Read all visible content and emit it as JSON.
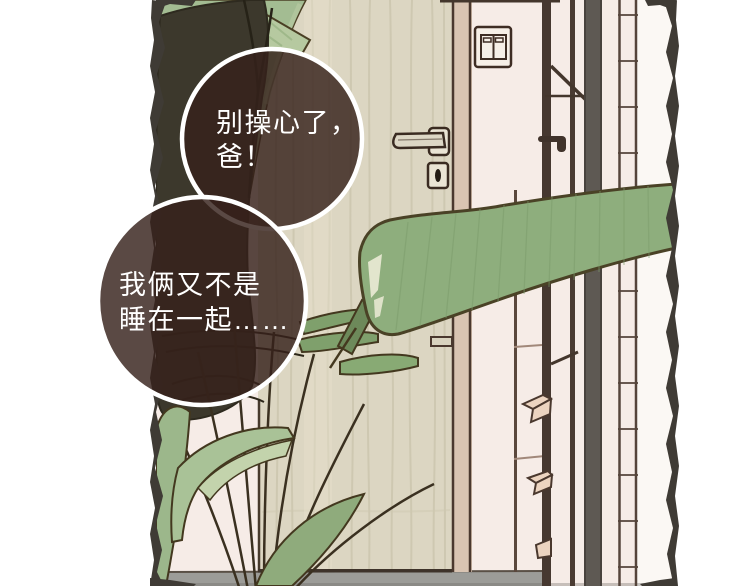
{
  "scene": {
    "bubbles": {
      "bubble1": {
        "lines": [
          "别操心了，",
          "爸！"
        ]
      },
      "bubble2": {
        "lines": [
          "我俩又不是",
          "睡在一起……"
        ]
      }
    },
    "colors": {
      "page_background": "#ffffff",
      "bubble_fill": "#36211b",
      "bubble_outline": "#ffffff",
      "bubble_text": "#ffffff",
      "wall_pink": "#f6ece7",
      "wall_white": "#fbf8f4",
      "door_wood": "#dcd6c2",
      "door_frame": "#d9c4b2",
      "leaf_light": "#a3bc92",
      "leaf_mid": "#8eae7d",
      "leaf_bright": "#a9c297",
      "leaf_dark": "#3c382c",
      "floor_gray": "#9c9c98",
      "bar_dark": "#463830",
      "bar_gray": "#5e5953",
      "line_dark": "#43381f",
      "torn_edge": "#3f3b35"
    },
    "icons": {
      "door_handle": "door-handle-icon",
      "keyhole": "keyhole-icon",
      "light_switch": "light-switch-icon"
    }
  }
}
